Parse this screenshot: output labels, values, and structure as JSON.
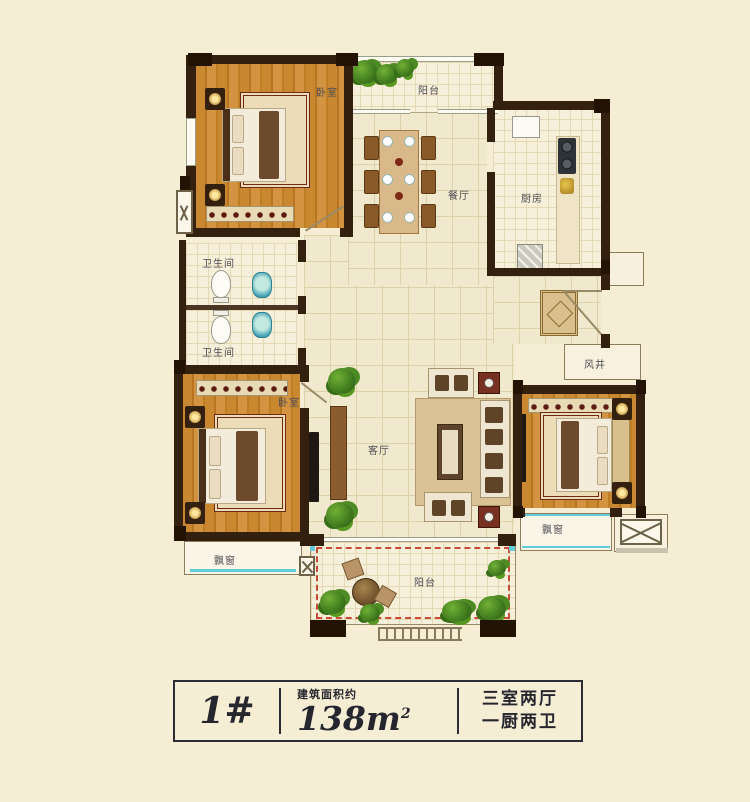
{
  "labels": {
    "balcony_top": "阳台",
    "bedroom1": "卧室",
    "dining": "餐厅",
    "kitchen": "厨房",
    "bath1": "卫生间",
    "bath2": "卫生间",
    "bedroom2": "卧室",
    "living": "客厅",
    "shaft": "风井",
    "bay_left": "飘窗",
    "bay_right": "飘窗",
    "balcony_bottom": "阳台"
  },
  "spec": {
    "unit": "1#",
    "area_caption": "建筑面积约",
    "area_value": "138m",
    "area_exponent": "2",
    "rooms_line1": "三室两厅",
    "rooms_line2": "一厨两卫"
  },
  "colors": {
    "background": "#f5eed5",
    "wall": "#33200e",
    "wood_floor": "#c9882f",
    "tile_floor": "#f1e9cd",
    "window_accent": "#62ccd8",
    "balcony_outline": "#c84b38",
    "text": "#26262e"
  }
}
